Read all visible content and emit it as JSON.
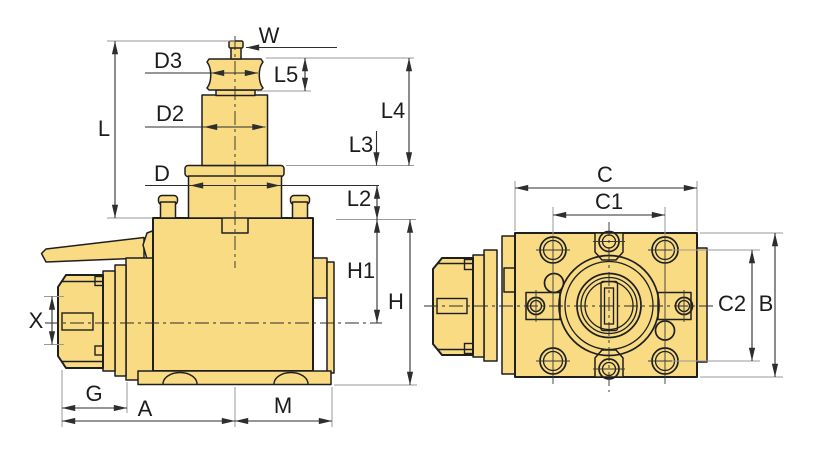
{
  "colors": {
    "background": "#ffffff",
    "part_fill": "#f8db82",
    "outline": "#1f1f1f",
    "dimension_line": "#2e2e2e",
    "extension_line": "#9a9a9a",
    "label_text": "#1c1c1c"
  },
  "drawing": {
    "views": {
      "side": {
        "dim_labels": {
          "W": "W",
          "D3": "D3",
          "L5": "L5",
          "D2": "D2",
          "L4": "L4",
          "L": "L",
          "L3": "L3",
          "D": "D",
          "L2": "L2",
          "H1": "H1",
          "H": "H",
          "X": "X",
          "G": "G",
          "A": "A",
          "M": "M"
        }
      },
      "front": {
        "dim_labels": {
          "C": "C",
          "C1": "C1",
          "C2": "C2",
          "B": "B"
        }
      }
    }
  }
}
